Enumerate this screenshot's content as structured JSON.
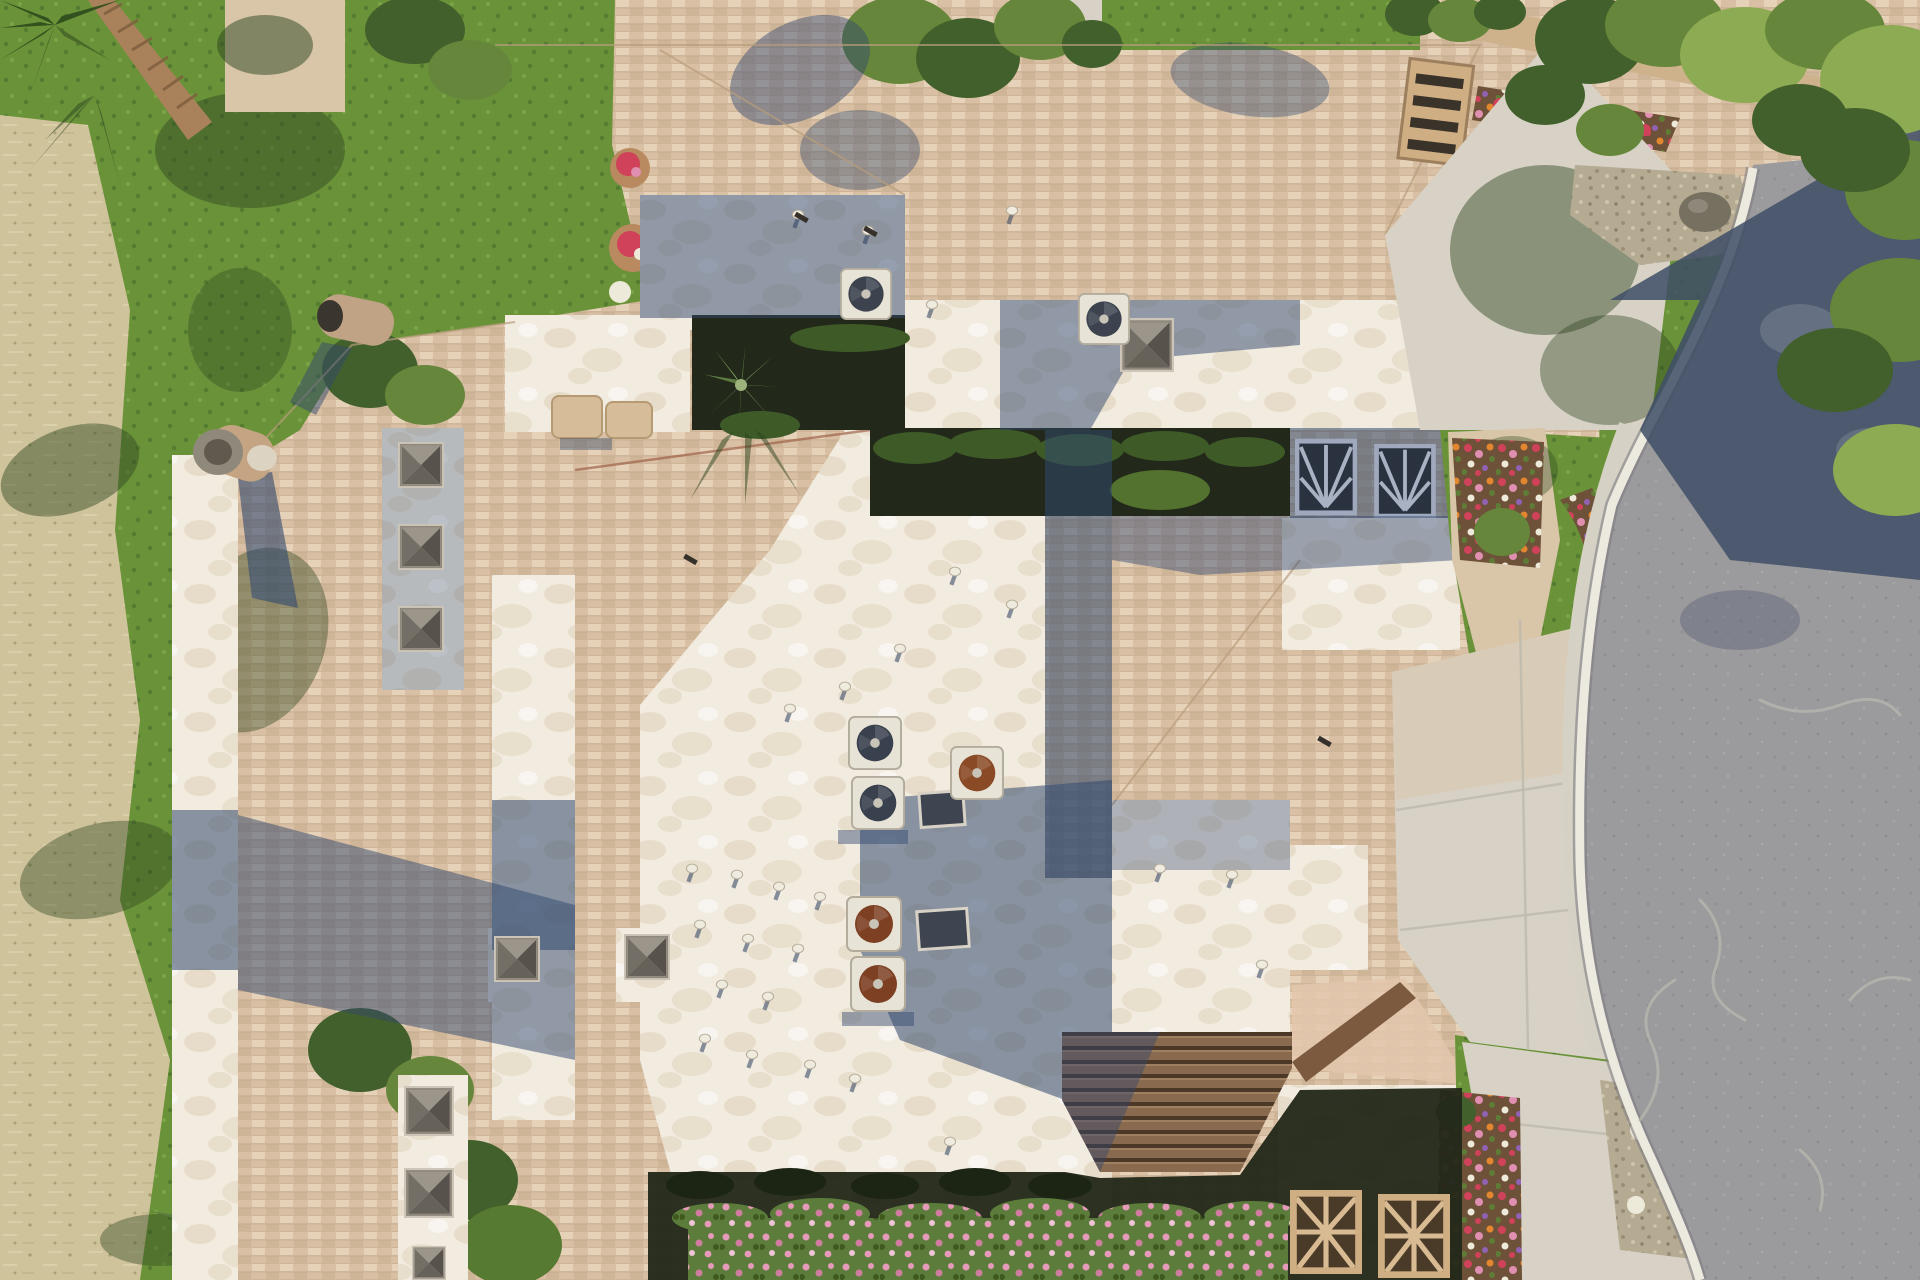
{
  "image": {
    "kind": "aerial drone photograph, top-down (nadir) view",
    "alt": "Top-down aerial photo of a Southwestern residential condo complex: tan shingle roofs and white foam flat roofs with skylight pyramids, rooftop AC fans and vent caps, a shaded interior courtyard with hedges, colorful flower beds, green lawns, dry golf-course rough on the left, and a curving gray asphalt street with a concrete sidewalk and tree shadows on the right",
    "time_of_day": "midday, strong sun casting short blue shadows toward lower-left"
  },
  "scene": {
    "left_strip": {
      "label": "golf rough and lawn",
      "elements": [
        "dry tan rough grass",
        "green lawn band",
        "palm tree at top-left corner",
        "shrub clusters",
        "yucca plant at bottom-left"
      ]
    },
    "buildings": {
      "label": "condo rooftops",
      "elements": [
        "tan asphalt-shingle hip roofs",
        "white elastomeric foam flat roofs with tan mottling",
        "white parapet strips",
        "pyramid skylights in rows of three",
        "flat glass skylights",
        "rooftop AC fan units (2 dark, 3 rusted)",
        "evaporative cooler on upper band",
        "white vent caps with shadows",
        "round metal chimney pipes",
        "tan chimney caps",
        "lattice chimney tower at upper right roof edge"
      ]
    },
    "courtyard": {
      "label": "shaded interior courtyard",
      "elements": [
        "dark walkway",
        "clipped hedges",
        "yucca in planter",
        "two shaded trellis windows"
      ]
    },
    "right_side": {
      "label": "street frontage",
      "elements": [
        "curving stamped asphalt road with crack-seal lines",
        "white concrete curb",
        "sidewalk",
        "two concrete driveways",
        "tan entry walkway",
        "flower beds of red, pink, orange, white and purple blooms",
        "green lawns",
        "gravel bed with boulder",
        "dense olive-green trees casting a large shadow across the road",
        "tan garden wall at top",
        "row of red flowers along the wall"
      ]
    },
    "bottom": {
      "label": "south edge",
      "elements": [
        "dark shaded patio band",
        "pink flowering hedge",
        "brown plank gable roof",
        "two sunburst lattice blocks on white garage wall"
      ]
    },
    "counts": {
      "pyramid_skylights": 9,
      "flat_skylights": 2,
      "ac_fan_units": 7,
      "vent_caps": 26,
      "flower_pots": 2,
      "trellis_windows": 2,
      "sunburst_lattice_blocks": 2,
      "boulders": 1
    }
  },
  "palette": {
    "dryGrass": "#cfc39b",
    "dryDark": "#a8a274",
    "green": "#6a9339",
    "greenDark": "#48702c",
    "shadowVeg": "#2c441f",
    "palmTrunk": "#a9815a",
    "palmFrond": "#33511f",
    "shingle": "#d9c0a4",
    "shingleLight": "#e6d2b9",
    "shingleDark": "#c6ab8c",
    "shingleLine": "#b89c7c",
    "shinglePink": "#e3c7ae",
    "foam": "#f1ebe0",
    "foamMottle": "#d8c4a4",
    "roofShadow": "#31486e",
    "darkCourtyard": "#23291a",
    "hedge": "#3d5a27",
    "hedgeLight": "#567a31",
    "concrete": "#d7d2c5",
    "concreteWarm": "#d9c6a8",
    "curb": "#eceadf",
    "sidewalk": "#d5d2c5",
    "asphalt": "#9b9a9c",
    "asphaltShadow": "#3e4d66",
    "crack": "#b8b5ae",
    "gravel": "#b5aa92",
    "boulder": "#75705f",
    "treeLight": "#8cab52",
    "treeMid": "#66873b",
    "treeDark": "#42602b",
    "flowerRed": "#d0415a",
    "flowerPink": "#e08fb1",
    "flowerOrange": "#e2862f",
    "flowerWhite": "#eeeada",
    "flowerPurple": "#9061b4",
    "soil": "#6d5138",
    "terracotta": "#b9895f",
    "acHousing": "#e8e3d7",
    "fanDark": "#3c434e",
    "fanRust": "#8a4a26",
    "skyFaceL": "#9b958a",
    "skyFaceM": "#746f66",
    "skyFaceD": "#57534c",
    "skyFrame": "#cdc6b8",
    "latticeTan": "#cfae83",
    "latticeDark": "#3a332a",
    "wallTan": "#cdb28c",
    "pinkHedgeBase": "#5c7c3b",
    "pinkBloom": "#e49ab8",
    "plank": "#8a6a4e",
    "plankDark": "#4c3827",
    "eaveBrown": "#7b5a40"
  }
}
